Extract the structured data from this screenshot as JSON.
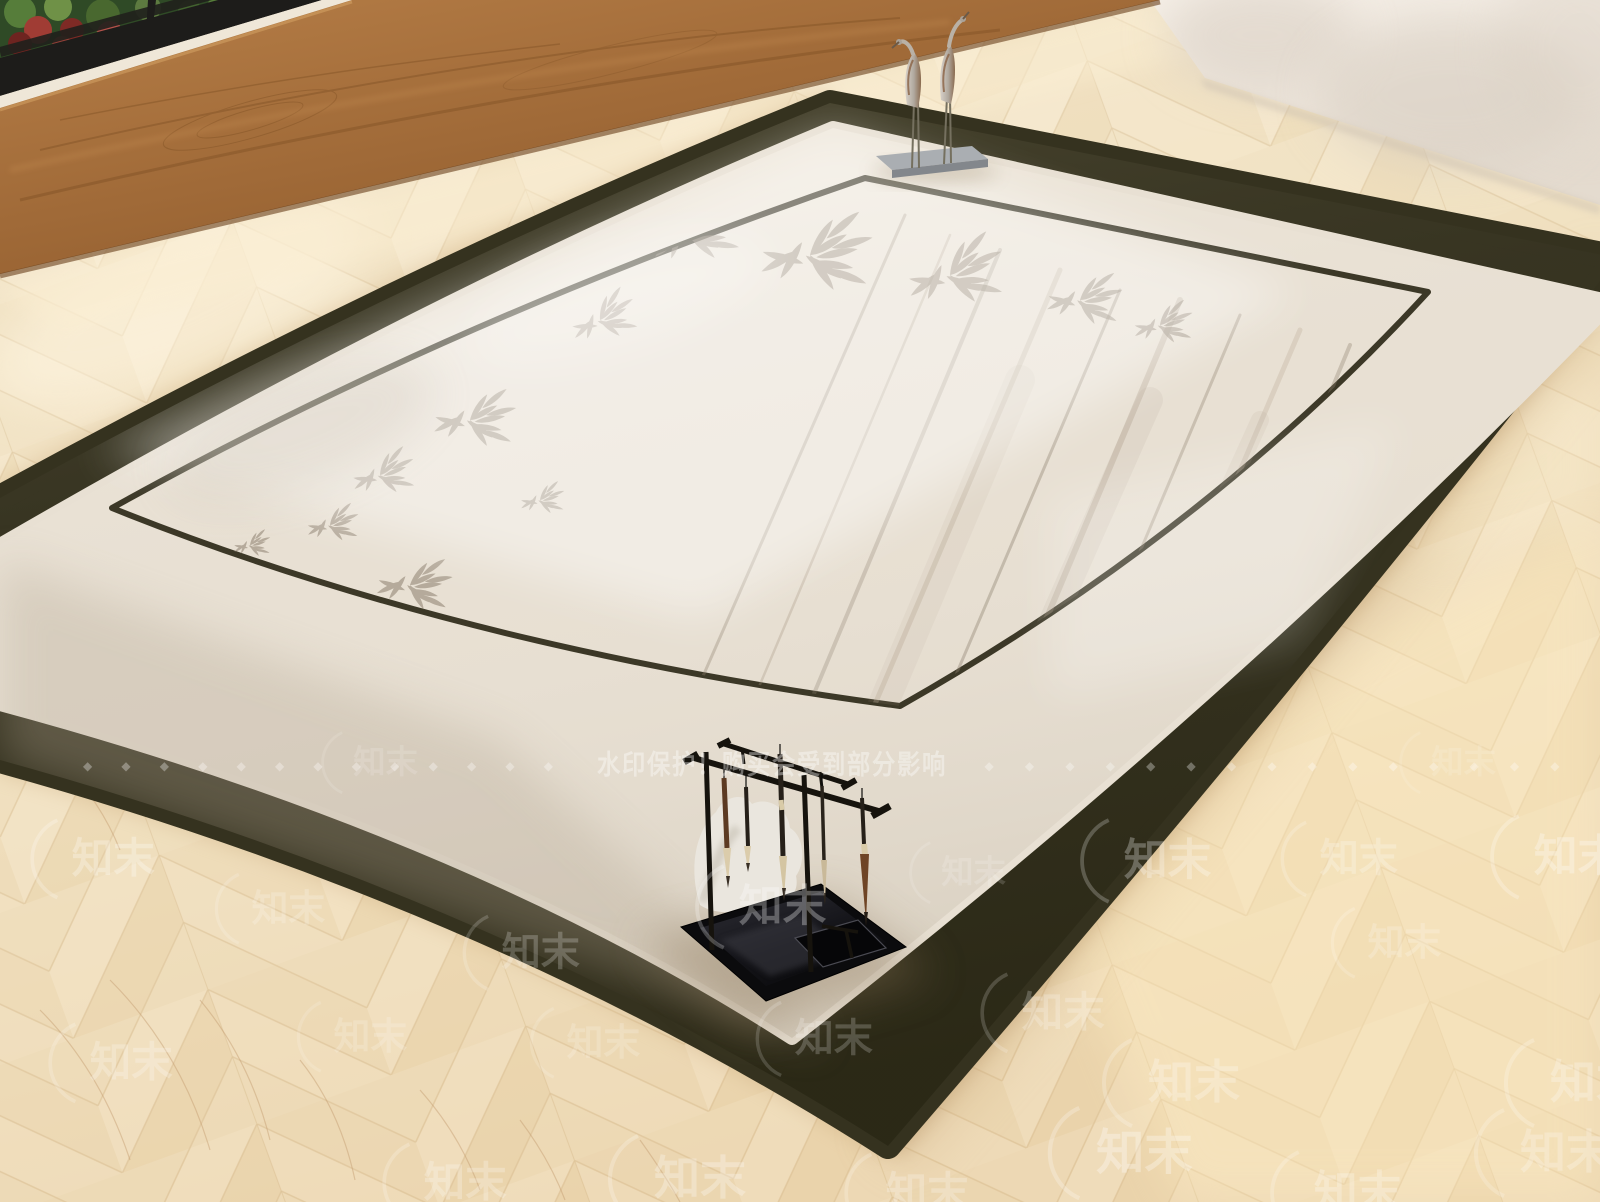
{
  "watermark": {
    "notice": "水印保护！购买会受到部分影响",
    "diamonds_left": "◆ ◆ ◆ ◆ ◆ ◆ ◆ ◆ ◆ ◆ ◆ ◆ ◆",
    "diamonds_right": "◆ ◆ ◆ ◆ ◆ ◆ ◆ ◆ ◆ ◆ ◆ ◆ ◆ ◆ ◆",
    "brand": "知末"
  },
  "colors": {
    "rug_border": "#35321f",
    "rug_field": "#e8e0d3",
    "inner_line": "#3c3827",
    "floor_base": "#f0e0bf",
    "plank_wood": "#a06a38",
    "wall": "#f2ece3",
    "watermark": "#ffffff"
  }
}
